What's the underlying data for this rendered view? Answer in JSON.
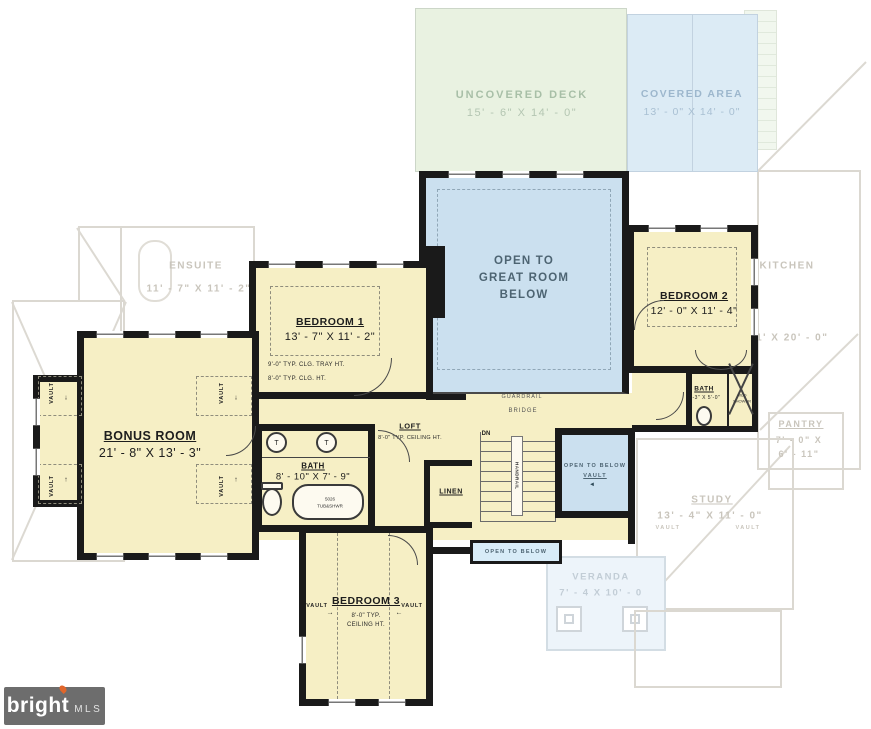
{
  "colors": {
    "wall": "#1a1a1a",
    "room_cream": "#f6efc5",
    "room_blue": "#cbe0ef",
    "open_below_blue": "#d8ecf8",
    "deck_green": "#e9f2e1",
    "covered_blue": "#dcebf5",
    "faded_line": "#dbd8d1",
    "faded_text": "#c9c5bc",
    "logo_bg": "#6d6d6d",
    "logo_flame": "#e0662b"
  },
  "logo": {
    "brand": "bright",
    "suffix": "MLS"
  },
  "arrows": {
    "up": "↑",
    "down": "↓",
    "left": "←",
    "right": "→",
    "left_solid": "◄"
  },
  "labels": {
    "vault": "VAULT",
    "guardrail": "GUARDRAIL",
    "bridge": "BRIDGE",
    "dn": "DN",
    "handrail": "HANDRAIL",
    "linen": "LINEN",
    "open_to_below": "OPEN TO BELOW",
    "sink_mark": "T"
  },
  "rooms": {
    "uncovered_deck": {
      "name": "UNCOVERED DECK",
      "dims": "15' - 6\" X 14' - 0\""
    },
    "covered_area": {
      "name": "COVERED AREA",
      "dims": "13' - 0\" X 14' - 0\""
    },
    "open_great_room": {
      "line1": "OPEN TO",
      "line2": "GREAT ROOM",
      "line3": "BELOW"
    },
    "bedroom1": {
      "name": "BEDROOM 1",
      "dims": "13' - 7\" X 11' - 2\"",
      "note1": "9'-0\" TYP. CLG. TRAY HT.",
      "note2": "8'-0\" TYP. CLG. HT."
    },
    "bedroom2": {
      "name": "BEDROOM 2",
      "dims": "12' - 0\" X 11' - 4\""
    },
    "bedroom3": {
      "name": "BEDROOM 3",
      "note1": "8'-0\" TYP.",
      "note2": "CEILING HT."
    },
    "bonus_room": {
      "name": "BONUS ROOM",
      "dims": "21' - 8\" X 13' - 3\""
    },
    "loft": {
      "name": "LOFT",
      "note": "8'-0\" TYP. CEILING HT."
    },
    "bath_main": {
      "name": "BATH",
      "dims": "8' - 10\" X 7' - 9\"",
      "tub_line1": "5026",
      "tub_line2": "TUB&SHWR"
    },
    "bath2": {
      "name": "BATH",
      "dims": "8'-3\" X 5'-0\"",
      "shower_line1": "MUD",
      "shower_line2": "SHOWER"
    },
    "open_below_vault": {
      "line1": "OPEN TO BELOW",
      "line2": "VAULT"
    },
    "ensuite": {
      "name": "ENSUITE",
      "dims": "11' - 7\" X 11' - 2\""
    },
    "kitchen": {
      "name": "KITCHEN",
      "dims": "11' X 20' - 0\""
    },
    "pantry": {
      "name": "PANTRY",
      "dims1": "7' - 0\" X",
      "dims2": "6' - 11\""
    },
    "study": {
      "name": "STUDY",
      "dims": "13' - 4\" X 11' - 0\""
    },
    "veranda": {
      "name": "VERANDA",
      "dims": "7' - 4 X 10' - 0"
    }
  }
}
